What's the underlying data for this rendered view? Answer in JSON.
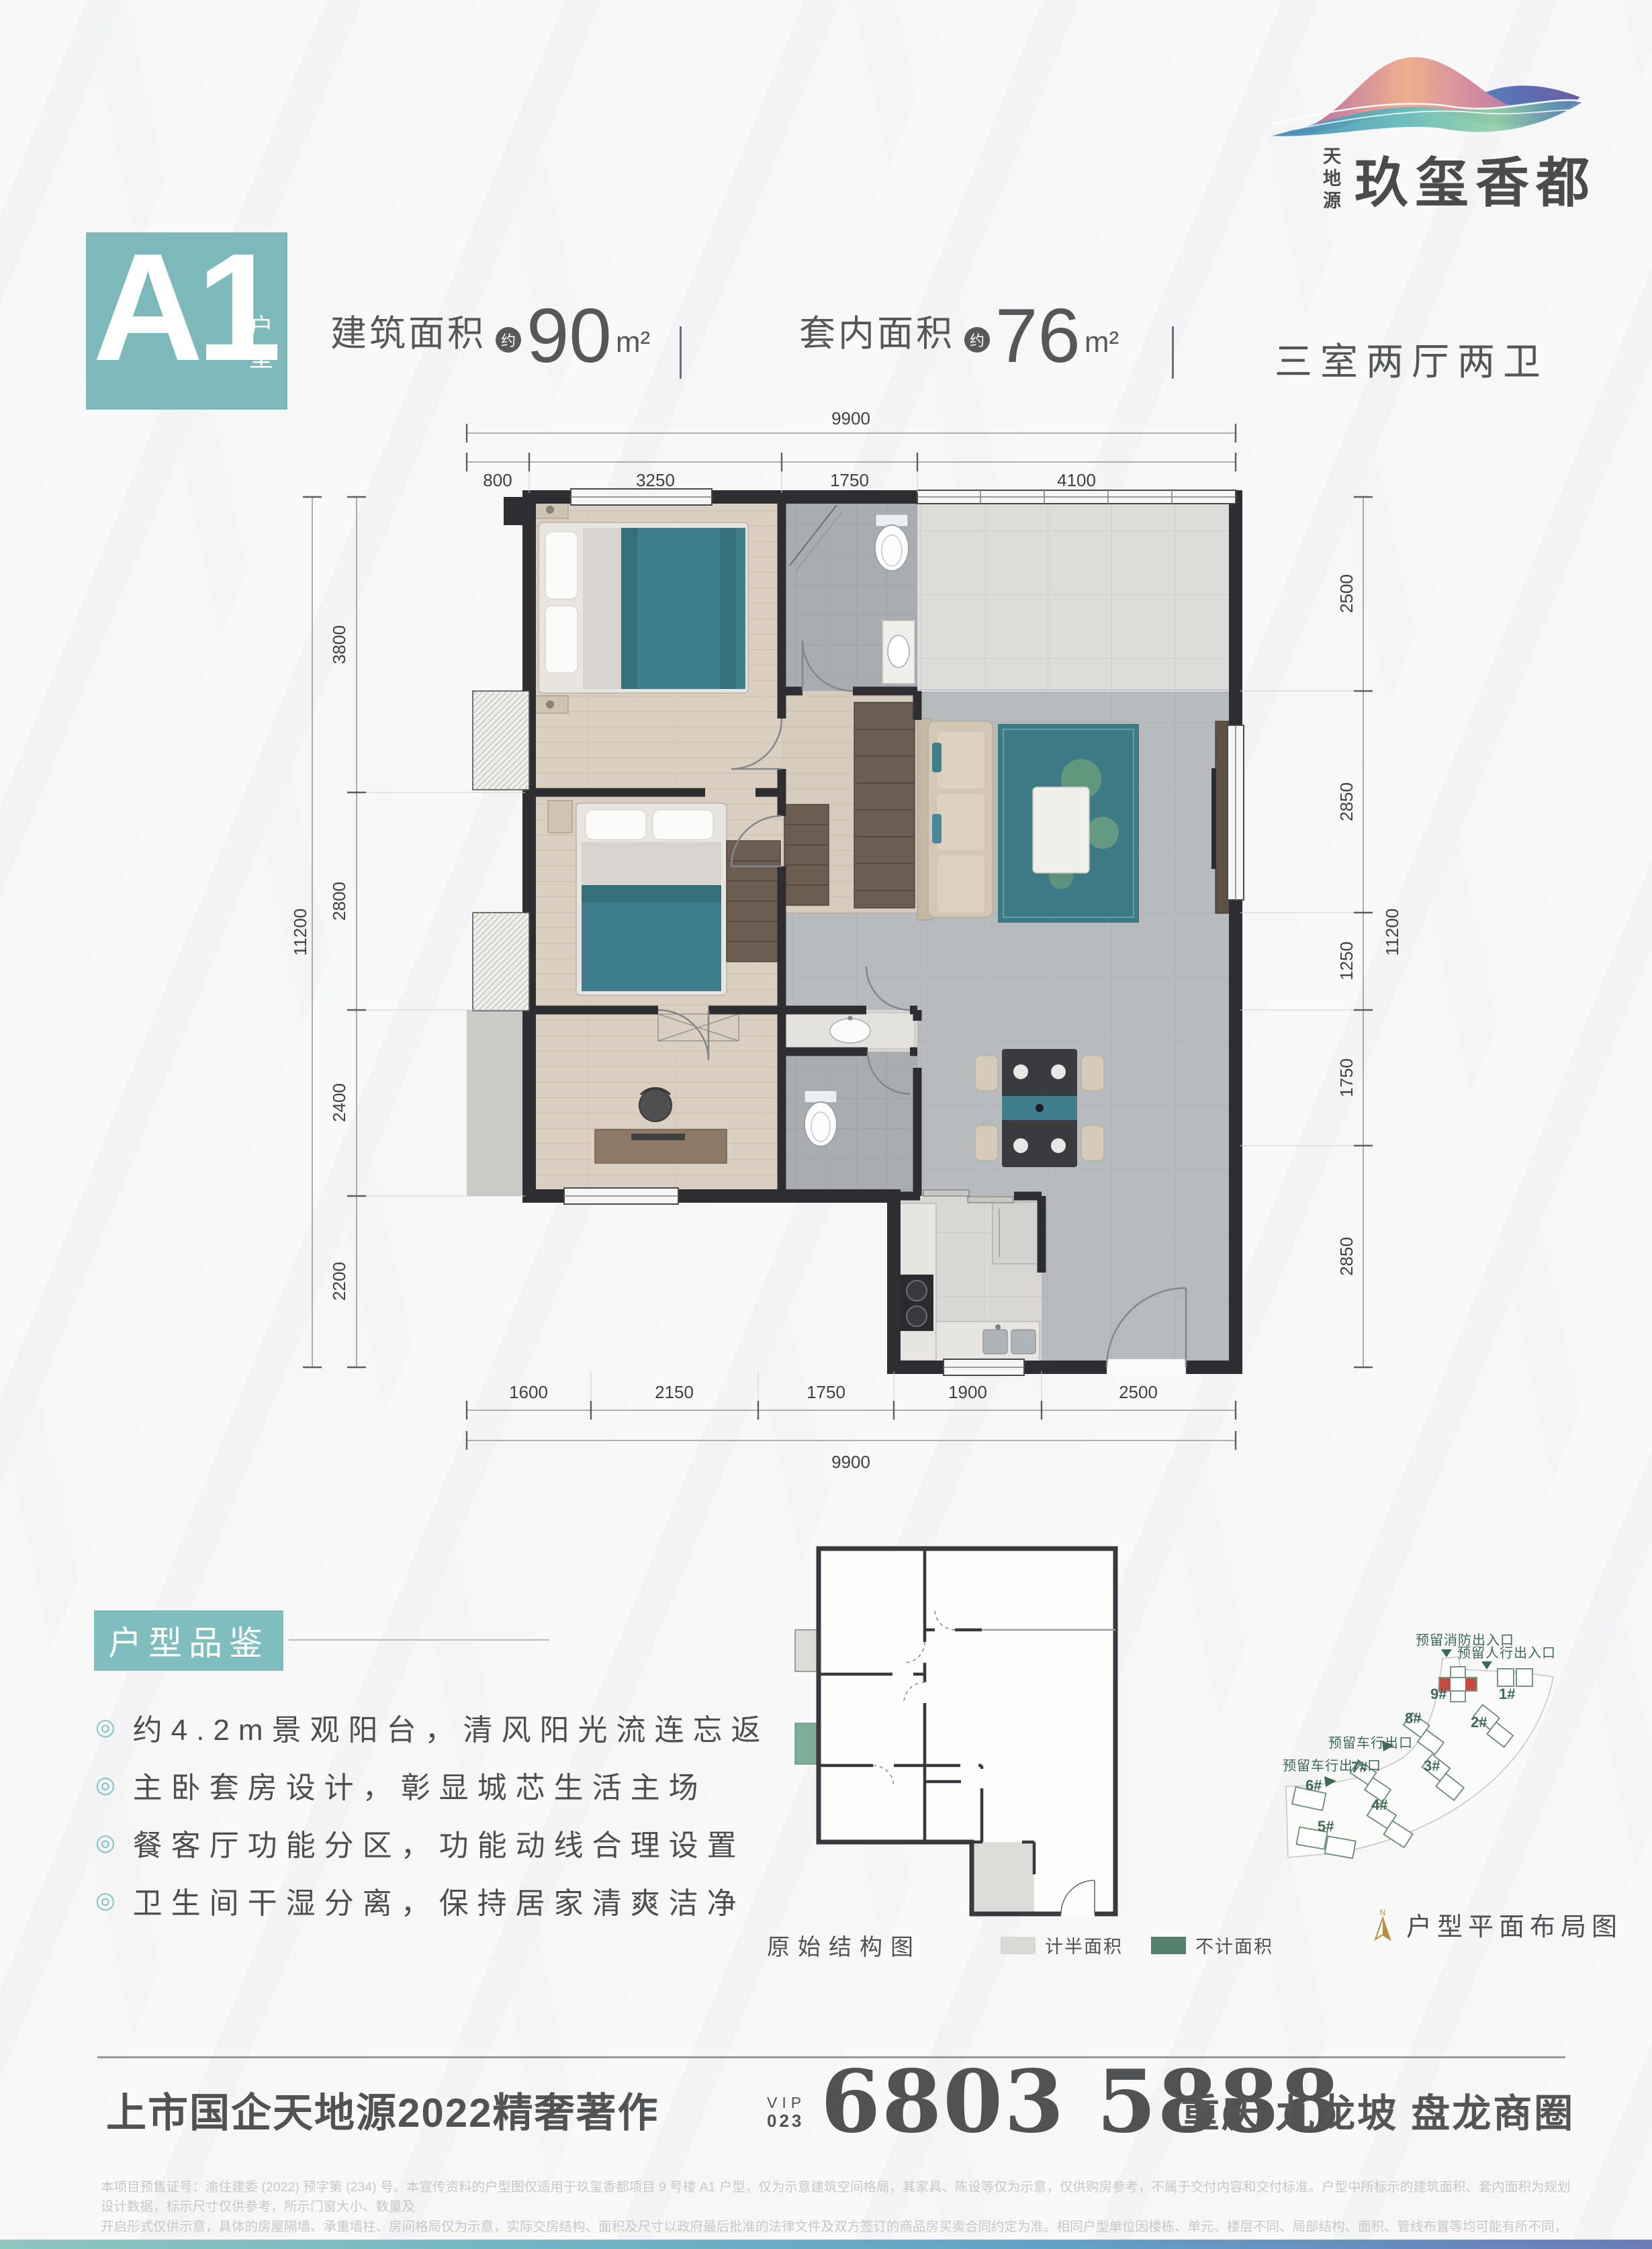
{
  "brand": {
    "vertical_name": "天地源",
    "name": "玖玺香都"
  },
  "unit_badge": {
    "code": "A1",
    "suffix": "户型"
  },
  "header": {
    "metrics": [
      {
        "label": "建筑面积",
        "approx": "约",
        "value": "90",
        "unit": "m²"
      },
      {
        "label": "套内面积",
        "approx": "约",
        "value": "76",
        "unit": "m²"
      }
    ],
    "layout_text": "三室两厅两卫"
  },
  "plan": {
    "top": {
      "total": "9900",
      "segments": [
        "800",
        "3250",
        "1750",
        "4100"
      ]
    },
    "left": {
      "total": "11200",
      "segments": [
        "3800",
        "2800",
        "2400",
        "2200"
      ]
    },
    "right": {
      "total": "11200",
      "segments": [
        "2500",
        "2850",
        "1250",
        "1750",
        "2850"
      ]
    },
    "bottom": {
      "total": "9900",
      "segments": [
        "1600",
        "2150",
        "1750",
        "1900",
        "2500"
      ]
    }
  },
  "features": {
    "title": "户型品鉴",
    "items": [
      "约4.2m景观阳台，清风阳光流连忘返",
      "主卧套房设计，彰显城芯生活主场",
      "餐客厅功能分区，功能动线合理设置",
      "卫生间干湿分离，保持居家清爽洁净"
    ]
  },
  "structure_diagram": {
    "caption": "原始结构图",
    "legend_half": "计半面积",
    "legend_excluded": "不计面积"
  },
  "site_plan": {
    "annotations": {
      "fire_exit": "预留消防出入口",
      "pedestrian": "预留人行出入口",
      "vehicle_exit": "预留车行出口",
      "vehicle_entrance": "预留车行出入口"
    },
    "buildings": [
      "1#",
      "2#",
      "3#",
      "4#",
      "5#",
      "6#",
      "7#",
      "8#",
      "9#"
    ],
    "compass": "N",
    "caption": "户型平面布局图"
  },
  "footer": {
    "slogan": "上市国企天地源2022精奢著作",
    "vip": "VIP",
    "vip_code": "023",
    "phone": "6803 5888",
    "location": "重庆 九龙坡 盘龙商圈",
    "disclaimer_1": "本项目预售证号：渝住建委 (2022) 预字第 (234) 号。本宣传资料的户型图仅适用于玖玺香都项目 9 号楼 A1 户型，仅为示意建筑空间格局，其家具、陈设等仅为示意，仅供购房参考，不属于交付内容和交付标准。户型中所标示的建筑面积、套内面积为规划设计数据，标示尺寸仅供参考，所示门窗大小、数量及",
    "disclaimer_2": "开启形式仅供示意，具体的房屋隔墙、承重墙柱、房间格局仅为示意，实际交房结构、面积及尺寸以政府最后批准的法律文件及双方签订的商品房买卖合同约定为准。相同户型单位因楼栋、单元、楼层不同、局部结构、面积、管线布置等均可能有所不同，具体交付单位细节最终应以实际交付为准。"
  },
  "colors": {
    "accent": "#7db9bb",
    "site_green": "#3f6a55",
    "highlight_red": "#c64a42",
    "gold": "#b5913f"
  }
}
